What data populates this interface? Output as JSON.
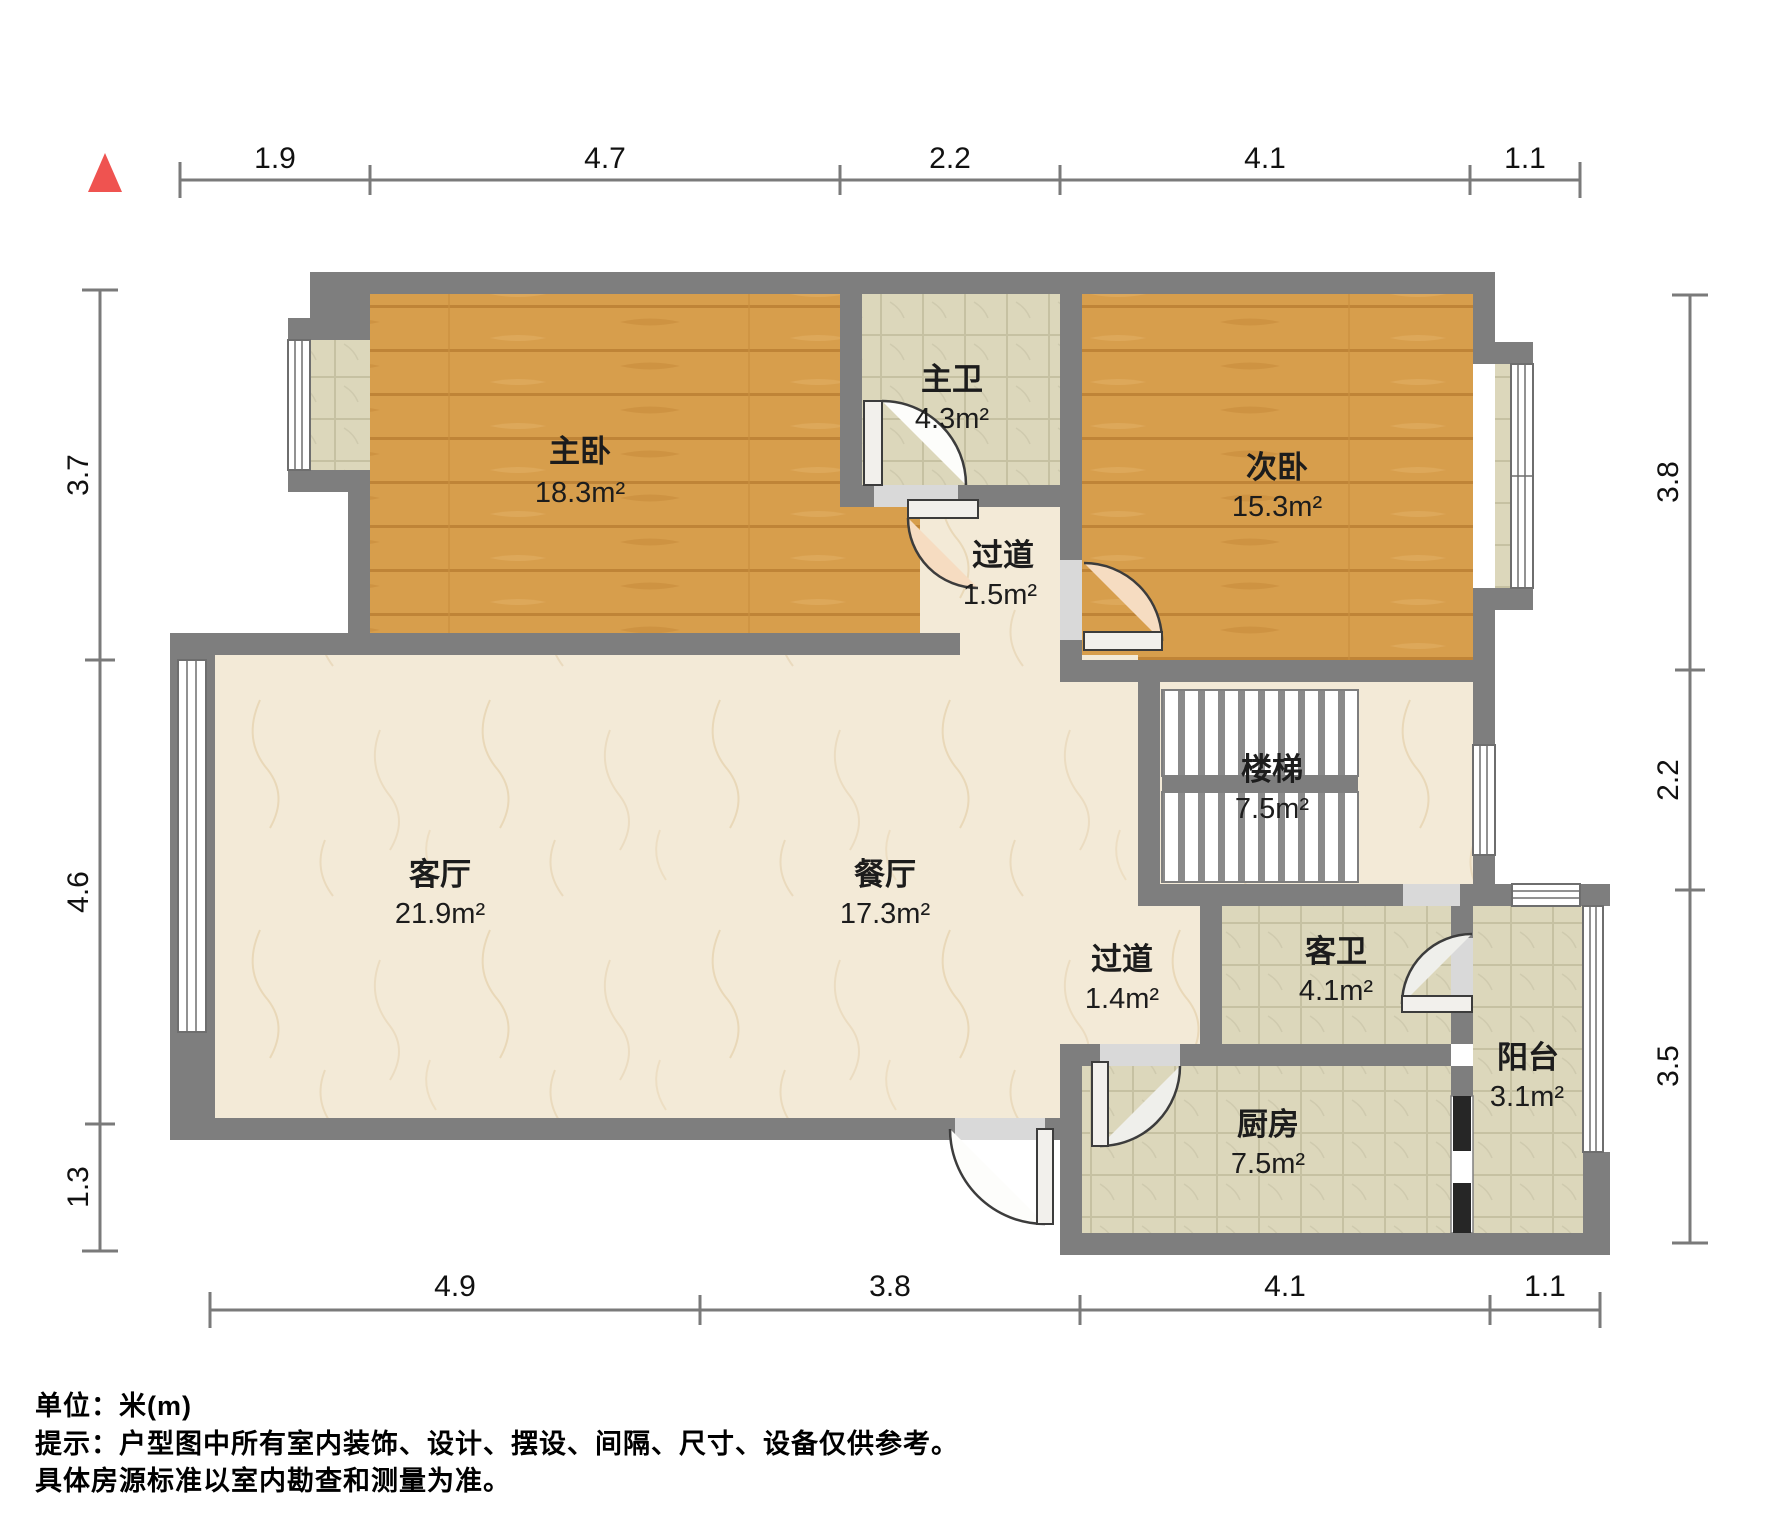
{
  "title": "户型图",
  "north_marker": "north-arrow",
  "colors": {
    "wall": "#7e7e7e",
    "wood_floor": "#d79e4c",
    "marble_floor": "#f3ead7",
    "tile_floor": "#dcd7bb",
    "north_arrow": "#ef5350",
    "door_peach": "#f6dcc1"
  },
  "rooms": [
    {
      "id": "master-bedroom",
      "name": "主卧",
      "area": "18.3m²"
    },
    {
      "id": "master-bath",
      "name": "主卫",
      "area": "4.3m²"
    },
    {
      "id": "second-bedroom",
      "name": "次卧",
      "area": "15.3m²"
    },
    {
      "id": "hallway-upper",
      "name": "过道",
      "area": "1.5m²"
    },
    {
      "id": "stairs",
      "name": "楼梯",
      "area": "7.5m²"
    },
    {
      "id": "living-room",
      "name": "客厅",
      "area": "21.9m²"
    },
    {
      "id": "dining-room",
      "name": "餐厅",
      "area": "17.3m²"
    },
    {
      "id": "hallway-lower",
      "name": "过道",
      "area": "1.4m²"
    },
    {
      "id": "guest-bath",
      "name": "客卫",
      "area": "4.1m²"
    },
    {
      "id": "kitchen",
      "name": "厨房",
      "area": "7.5m²"
    },
    {
      "id": "balcony",
      "name": "阳台",
      "area": "3.1m²"
    }
  ],
  "dimensions": {
    "top": [
      "1.9",
      "4.7",
      "2.2",
      "4.1",
      "1.1"
    ],
    "bottom": [
      "4.9",
      "3.8",
      "4.1",
      "1.1"
    ],
    "left": [
      "3.7",
      "4.6",
      "1.3"
    ],
    "right": [
      "3.8",
      "2.2",
      "3.5"
    ]
  },
  "footer": {
    "unit_note": "单位：米(m)",
    "disclaimer_line1": "提示：户型图中所有室内装饰、设计、摆设、间隔、尺寸、设备仅供参考。",
    "disclaimer_line2": "具体房源标准以室内勘查和测量为准。"
  }
}
